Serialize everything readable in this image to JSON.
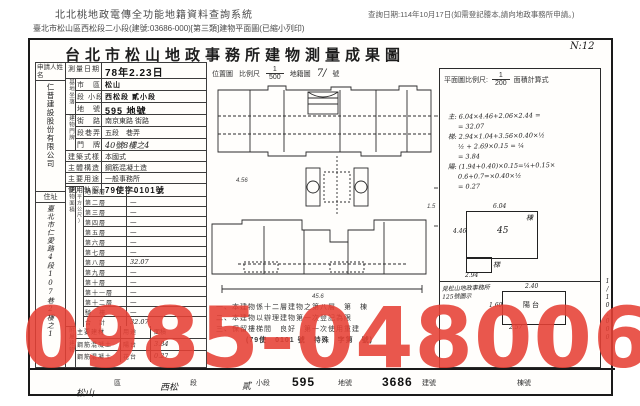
{
  "header": {
    "system_title": "北北桃地政電傳全功能地籍資料查詢系統",
    "query_date": "查詢日期:114年10月17日(如需登記謄本,請向地政事務所申請。)",
    "doc_line": "臺北市松山區西松段二小段(建號:03686-000)[第三類]建物平面圖(已縮小列印)"
  },
  "document": {
    "title": "台北市松山地政事務所建物測量成果圖",
    "page_note": "N:12",
    "scale_row": {
      "location_map": "位置圖",
      "scale_label": "比例尺",
      "scale_num": "1",
      "scale_den": "500",
      "cadastral": "地籍圖",
      "cadastral_no": "7/",
      "unit": "號"
    },
    "plan_scale": {
      "label": "平面圖比例尺:",
      "num": "1",
      "den": "200",
      "calc_title": "面積計算式"
    },
    "side_scale": "1/10,000"
  },
  "form": {
    "applicant_label": "申請人姓名",
    "applicant_name": "仁普建設股份有限公司",
    "address_label": "住址",
    "address": "臺北市仁愛路4段107巷2樓之1",
    "survey_date_label": "測量日期",
    "survey_date": "78年2.23日",
    "site_group_label": "基地坐落",
    "door_group_label": "建物門牌",
    "rows": [
      {
        "label": "市　區",
        "value": "松山"
      },
      {
        "label": "段 小段",
        "value": "西松段 貳小段"
      },
      {
        "label": "地　號",
        "value": "595 地號"
      },
      {
        "label": "街　路",
        "value": "南京東路 街路"
      },
      {
        "label": "段巷弄",
        "value": "五段　巷弄"
      },
      {
        "label": "門　牌",
        "value": "40號8樓之4"
      },
      {
        "label": "建築式樣",
        "value": "本國式"
      },
      {
        "label": "主體構造",
        "value": "鋼筋混凝土造"
      },
      {
        "label": "主要用途",
        "value": "一般事務所"
      },
      {
        "label": "使用執照",
        "value": "79使字0101號"
      }
    ],
    "area_label": "建物面積",
    "area_unit": "(平方公尺)"
  },
  "floors": [
    {
      "label": "地面層",
      "value": "—"
    },
    {
      "label": "第二層",
      "value": "—"
    },
    {
      "label": "第三層",
      "value": "—"
    },
    {
      "label": "第四層",
      "value": "—"
    },
    {
      "label": "第五層",
      "value": "—"
    },
    {
      "label": "第六層",
      "value": "—"
    },
    {
      "label": "第七層",
      "value": "—"
    },
    {
      "label": "第八層",
      "value": "32.07"
    },
    {
      "label": "第九層",
      "value": "—"
    },
    {
      "label": "第十層",
      "value": "—"
    },
    {
      "label": "第十一層",
      "value": "—"
    },
    {
      "label": "第十二層",
      "value": "—"
    },
    {
      "label": "騎　樓",
      "value": "—"
    },
    {
      "label": "合　計",
      "value": "32.07"
    }
  ],
  "attached": {
    "group_label": "附屬建物",
    "headers": {
      "material": "主要建材",
      "use": "用途",
      "area": "面積"
    },
    "rows": [
      {
        "material": "鋼筋混凝土",
        "use": "陽台",
        "area": "3.84"
      },
      {
        "material": "鋼筋混凝土",
        "use": "花台",
        "area": "0.27"
      }
    ]
  },
  "calc_lines": [
    "主: 6.04×4.46+2.06×2.44 =",
    "= 32.07",
    "梯: 2.94×1.04+3.56×0.40×½",
    "½ + 2.69×0.15 = ¼",
    "= 3.84",
    "陽: (1.94+0.40)×0.15=¼+0.15×",
    "0.6+0.7=×0.40×½",
    "= 0.27"
  ],
  "sketch_main": {
    "dim_top": "6.04",
    "dim_left": "4.46",
    "unit_no": "45",
    "stair": "梯",
    "dim_bottom": "2.94",
    "corner": "棟"
  },
  "sketch_balcony": {
    "label": "陽台",
    "dim_top": "2.40",
    "dim_left": "1.60",
    "dim_bottom": "2.57"
  },
  "sketch_note": {
    "line1": "見松山地政事務所",
    "line2": "125號圖示"
  },
  "plan_dims": {
    "d1": "4.56",
    "d2": "45.6",
    "d3": "1.5"
  },
  "notes": [
    "一、本建物係十二層建物之第八層　第　棟",
    "二、本建物以辦理建物第一次登記為限",
    "三、保留樓梯間　良好　第一次使用重建",
    "(79使　0101 號　特殊　字第　號)"
  ],
  "bottom": {
    "district_hand": "松山",
    "district": "區",
    "section_hand": "西松",
    "section": "段",
    "subsection_hand": "貳",
    "subsection": "小段",
    "lot": "595",
    "lot_label": "地號",
    "building_no": "3686",
    "building_label": "建號",
    "unit_label": "棟號"
  },
  "watermark": "0985-048006",
  "colors": {
    "watermark_red": "#e64034",
    "ink": "#2e2e2e"
  }
}
